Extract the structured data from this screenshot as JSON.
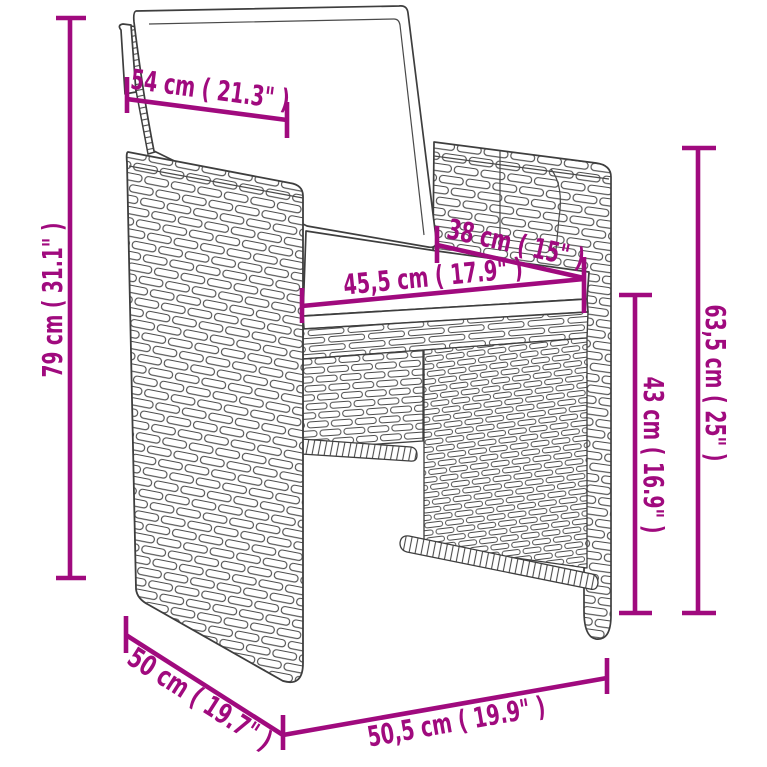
{
  "colors": {
    "dimension_accent": "#A00A7E",
    "line_art": "#3E3E3E",
    "background": "#FFFFFF"
  },
  "product": {
    "type": "rattan-cube-armchair-with-cushions"
  },
  "dimensions": {
    "back_width": {
      "label": "54 cm ( 21.3\" )"
    },
    "total_height": {
      "label": "79 cm ( 31.1\" )"
    },
    "seat_depth": {
      "label": "38 cm ( 15\" )"
    },
    "seat_width": {
      "label": "45,5 cm ( 17.9\" )"
    },
    "armrest_height": {
      "label": "63,5 cm ( 25\" )"
    },
    "seat_height": {
      "label": "43 cm ( 16.9\" )"
    },
    "side_depth": {
      "label": "50 cm ( 19.7\" )"
    },
    "front_width": {
      "label": "50,5 cm ( 19.9\" )"
    }
  }
}
